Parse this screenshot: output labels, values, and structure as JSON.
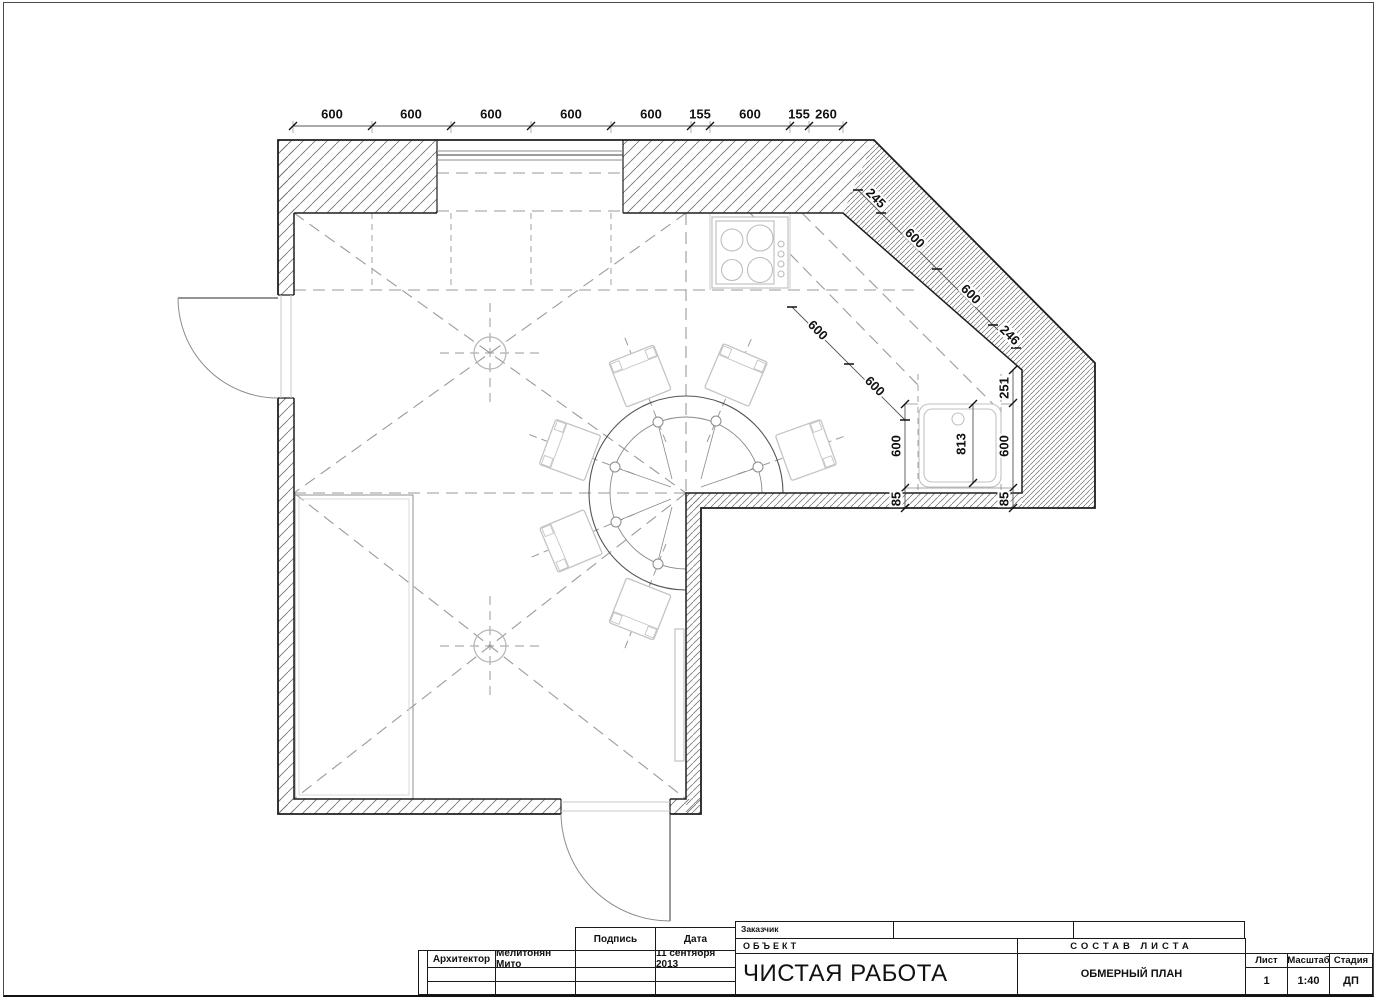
{
  "title_block": {
    "customer_label": "Заказчик",
    "object_label": "ОБЪЕКТ",
    "project_title": "ЧИСТАЯ РАБОТА",
    "sostav_label": "СОСТАВ  ЛИСТА",
    "drawing_name": "ОБМЕРНЫЙ ПЛАН",
    "signature_label": "Подпись",
    "date_label": "Дата",
    "architect_label": "Архитектор",
    "architect_name": "Мелитонян Мито",
    "date_value": "11 сентября 2013",
    "sheet_label": "Лист",
    "sheet_value": "1",
    "scale_label": "Масштаб",
    "scale_value": "1:40",
    "stage_label": "Стадия",
    "stage_value": "ДП"
  },
  "plan": {
    "scale_note": "1:40",
    "dim_labels": [
      {
        "t": "600",
        "x": 332,
        "y": 114,
        "r": 0
      },
      {
        "t": "600",
        "x": 411,
        "y": 114,
        "r": 0
      },
      {
        "t": "600",
        "x": 491,
        "y": 114,
        "r": 0
      },
      {
        "t": "600",
        "x": 571,
        "y": 114,
        "r": 0
      },
      {
        "t": "600",
        "x": 651,
        "y": 114,
        "r": 0
      },
      {
        "t": "155",
        "x": 700,
        "y": 114,
        "r": 0
      },
      {
        "t": "600",
        "x": 750,
        "y": 114,
        "r": 0
      },
      {
        "t": "155",
        "x": 799,
        "y": 114,
        "r": 0
      },
      {
        "t": "260",
        "x": 826,
        "y": 114,
        "r": 0
      },
      {
        "t": "245",
        "x": 876,
        "y": 198,
        "r": 45
      },
      {
        "t": "600",
        "x": 915,
        "y": 238,
        "r": 45
      },
      {
        "t": "600",
        "x": 971,
        "y": 294,
        "r": 45
      },
      {
        "t": "246",
        "x": 1010,
        "y": 335,
        "r": 45
      },
      {
        "t": "600",
        "x": 818,
        "y": 330,
        "r": 45
      },
      {
        "t": "600",
        "x": 875,
        "y": 386,
        "r": 45
      },
      {
        "t": "600",
        "x": 896,
        "y": 446,
        "r": -90
      },
      {
        "t": "85",
        "x": 896,
        "y": 499,
        "r": -90
      },
      {
        "t": "813",
        "x": 961,
        "y": 444,
        "r": -90
      },
      {
        "t": "251",
        "x": 1004,
        "y": 388,
        "r": -90
      },
      {
        "t": "600",
        "x": 1004,
        "y": 446,
        "r": -90
      },
      {
        "t": "85",
        "x": 1004,
        "y": 499,
        "r": -90
      }
    ]
  }
}
